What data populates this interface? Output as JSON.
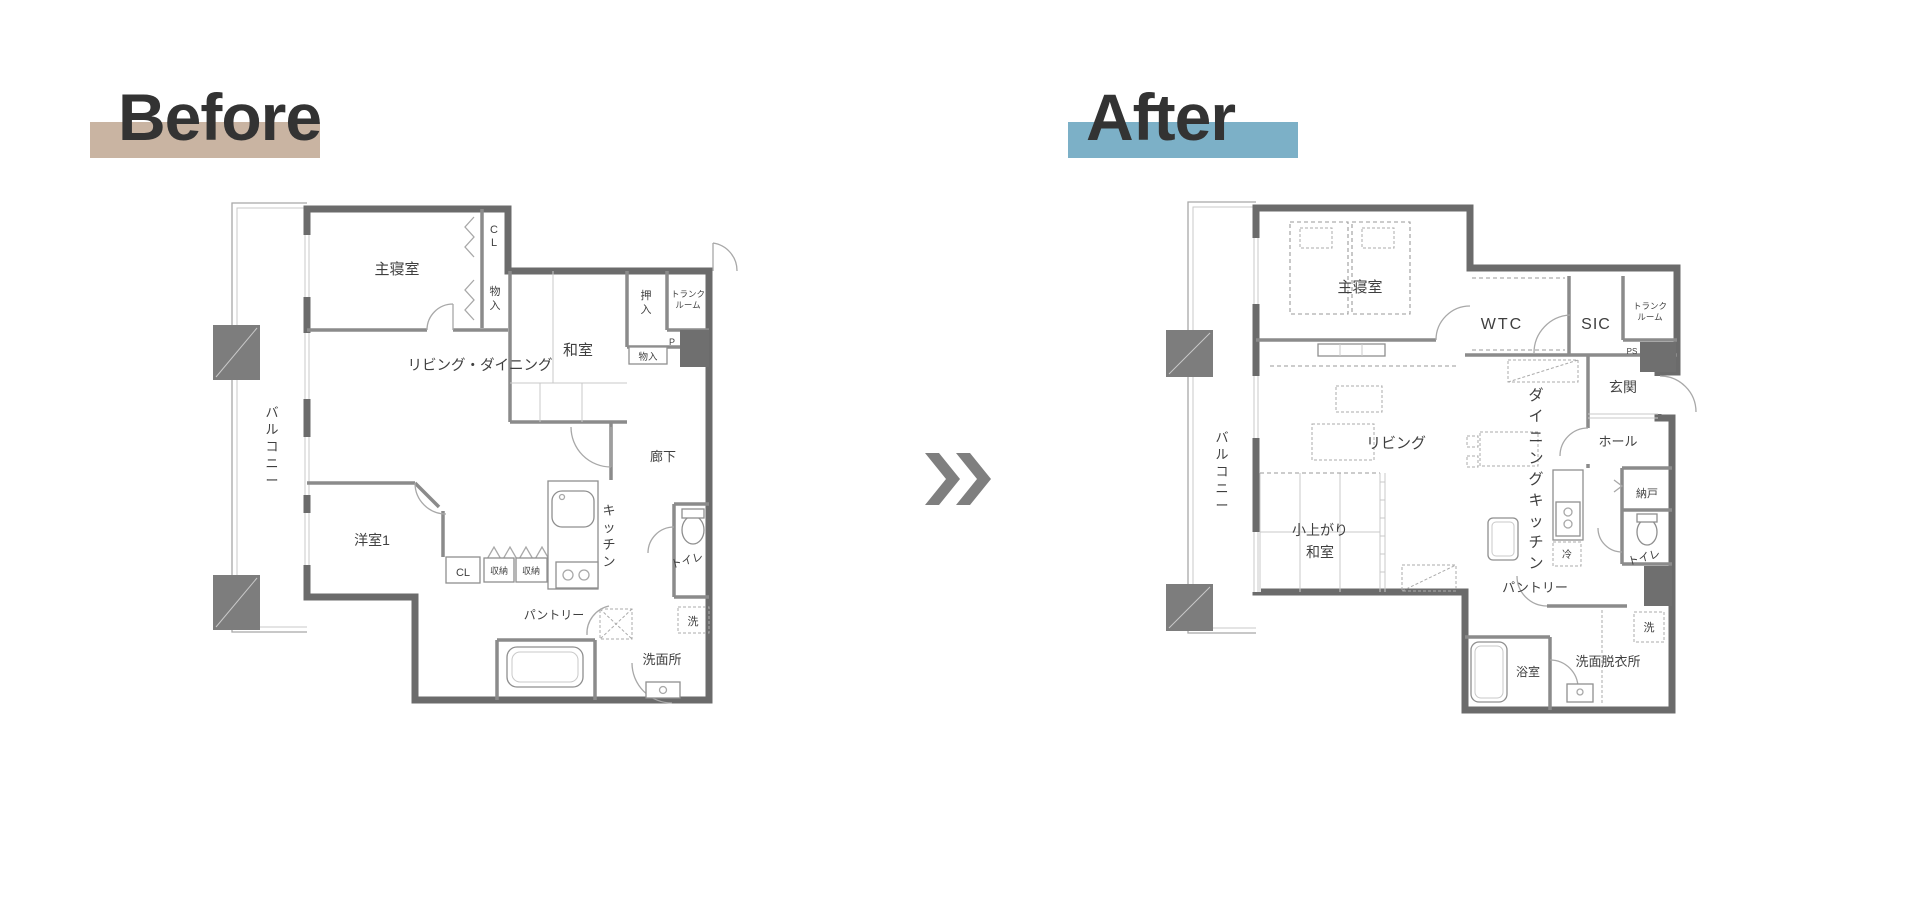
{
  "before": {
    "title": "Before",
    "highlight_color": "#c9b4a2",
    "rooms": {
      "balcony": "バルコニー",
      "master_bedroom": "主寝室",
      "cl_top": "CL",
      "storage_top": "物入",
      "washitsu": "和室",
      "oshiire": "押入",
      "trunk_line1": "トランク",
      "trunk_line2": "ルーム",
      "ps": "P",
      "storage_small": "物入",
      "living_dining": "リビング・ダイニング",
      "hallway": "廊下",
      "western_room": "洋室1",
      "cl_bottom": "CL",
      "storage_box1": "収納",
      "storage_box2": "収納",
      "kitchen": "キッチン",
      "toilet": "トイレ",
      "pantry": "パントリー",
      "laundry": "洗",
      "washroom": "洗面所"
    }
  },
  "after": {
    "title": "After",
    "highlight_color": "#7cb0c7",
    "rooms": {
      "balcony": "バルコニー",
      "master_bedroom": "主寝室",
      "wtc": "WTC",
      "sic": "SIC",
      "trunk_line1": "トランク",
      "trunk_line2": "ルーム",
      "ps": "PS",
      "entrance": "玄関",
      "hall": "ホール",
      "storage_room": "納戸",
      "living": "リビング",
      "dining_kitchen": "ダイニングキッチン",
      "tatami_line1": "小上がり",
      "tatami_line2": "和室",
      "fridge": "冷",
      "toilet": "トイレ",
      "pantry": "パントリー",
      "laundry": "洗",
      "bathroom": "浴室",
      "washroom": "洗面脱衣所"
    }
  },
  "arrow": {
    "name": "double-chevron-right",
    "color": "#7f7f7f"
  },
  "colors": {
    "wall": "#6b6b6b",
    "pillar": "#7d7d7d",
    "label_text": "#3f3f3f",
    "title_text": "#333333"
  }
}
